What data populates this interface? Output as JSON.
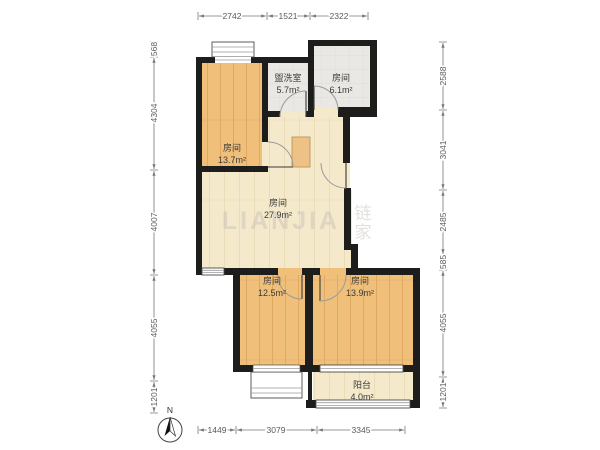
{
  "floorplan": {
    "rooms": [
      {
        "name": "房间",
        "area": "13.7m²"
      },
      {
        "name": "盥洗室",
        "area": "5.7m²"
      },
      {
        "name": "房间",
        "area": "6.1m²"
      },
      {
        "name": "房间",
        "area": "27.9m²"
      },
      {
        "name": "房间",
        "area": "12.5m²"
      },
      {
        "name": "房间",
        "area": "13.9m²"
      },
      {
        "name": "阳台",
        "area": "4.0m²"
      }
    ],
    "dimensions_mm": {
      "top": [
        "2742",
        "1521",
        "2322"
      ],
      "left": [
        "568",
        "4304",
        "4007",
        "4055",
        "1201"
      ],
      "right": [
        "2588",
        "3041",
        "2485",
        "585",
        "4055",
        "1201"
      ],
      "bottom": [
        "1449",
        "3079",
        "3345"
      ]
    },
    "compass": {
      "label": "N"
    },
    "watermark": {
      "brand": "LIANJIA",
      "logo_char_1": "链",
      "logo_char_2": "家"
    },
    "colors": {
      "wall": "#1d1d1b",
      "wood_floor": "#f0c07a",
      "pale_floor": "#f4e9cb",
      "tile_floor": "#eae8e5",
      "dim_text": "#5a5a5a"
    }
  }
}
